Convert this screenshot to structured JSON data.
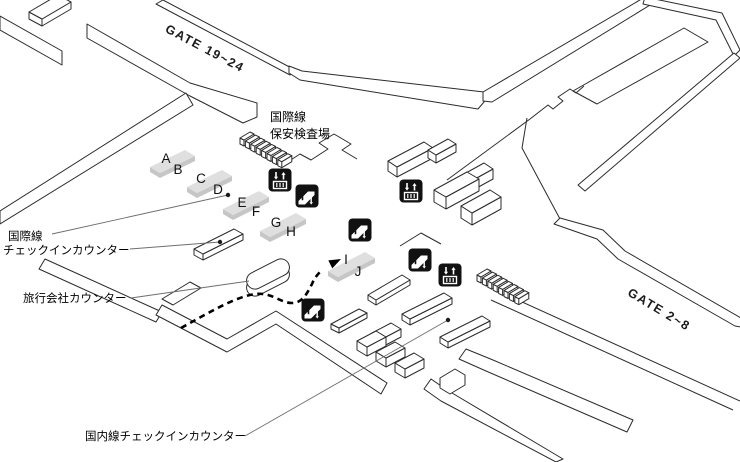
{
  "map": {
    "gate_labels": {
      "northwest": "GATE 19~24",
      "southeast": "GATE 2~8"
    },
    "area_labels": {
      "international_security": [
        "国際線",
        "保安検査場"
      ],
      "international_checkin": [
        "国際線",
        "チェックインカウンター"
      ],
      "travel_agency": "旅行会社カウンター",
      "domestic_checkin": "国内線チェックインカウンター"
    },
    "counter_letters": [
      "A",
      "B",
      "C",
      "D",
      "E",
      "F",
      "G",
      "H",
      "I",
      "J"
    ],
    "icon_legend": {
      "elevator": "↓↑",
      "escalator": "escalator"
    },
    "line_color": "#2b2b2b",
    "counter_fill": "#dfdfdf",
    "icon_bg": "#111111"
  }
}
